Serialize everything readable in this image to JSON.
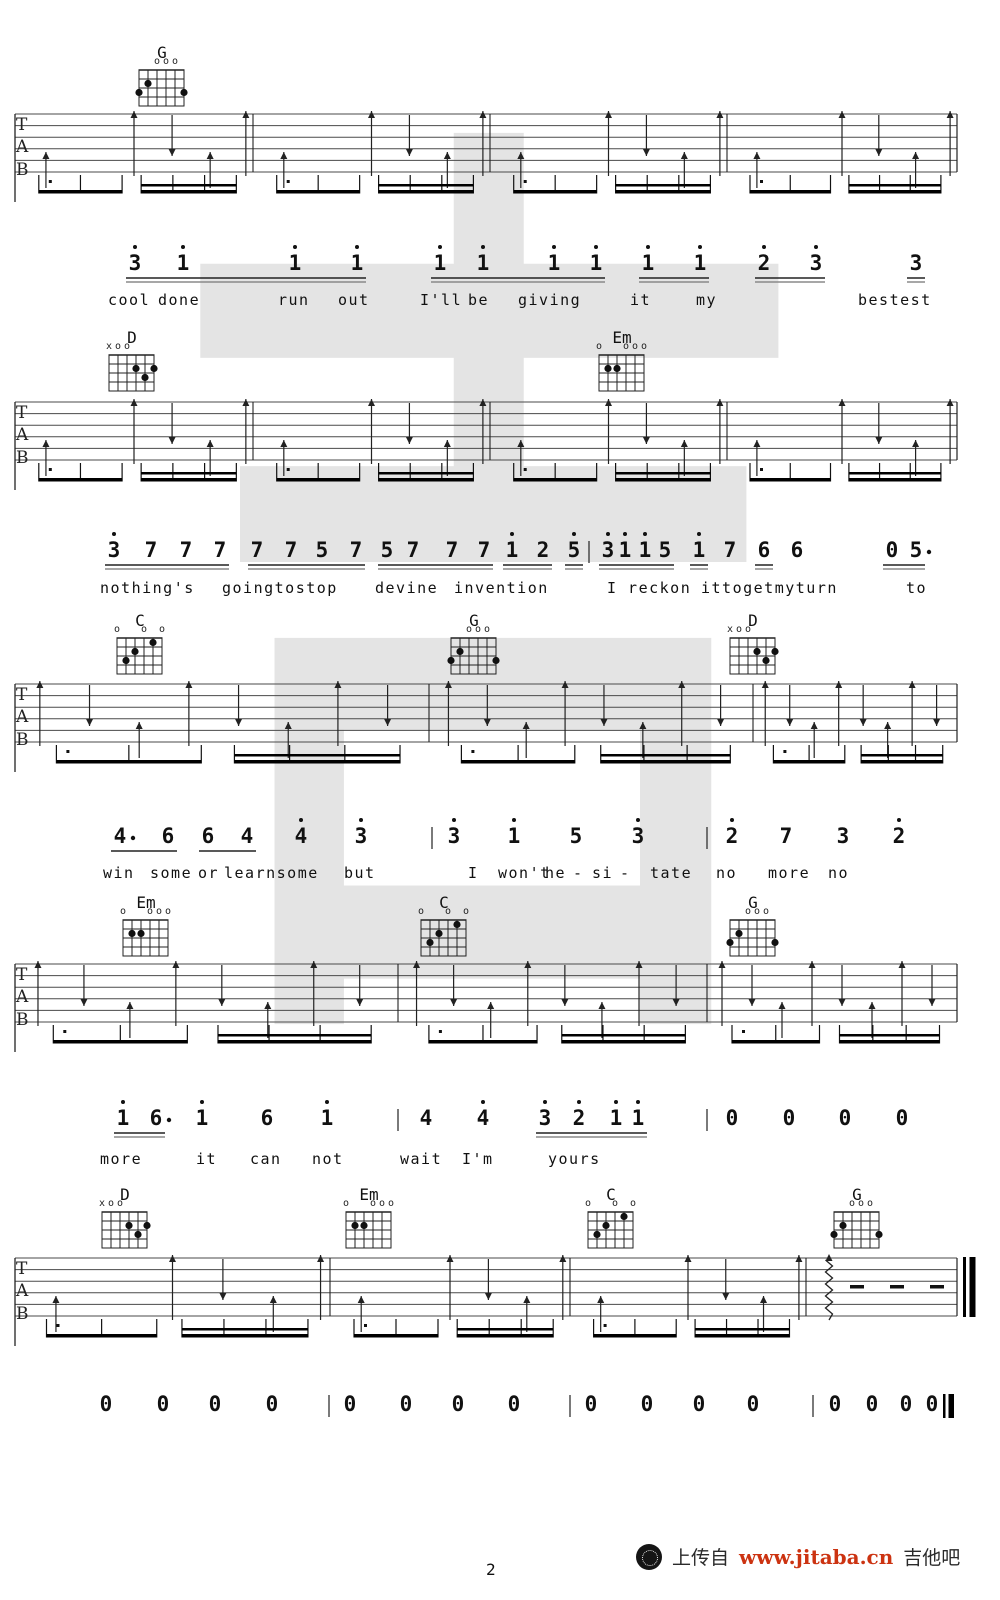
{
  "page": {
    "number": "2"
  },
  "watermark": {
    "glyph": "吉",
    "color": "#cfcfcf"
  },
  "tab_letters": [
    "T",
    "A",
    "B"
  ],
  "footer": {
    "upload_text": "上传自",
    "url": "www.jitaba.cn",
    "site_name": "吉他吧",
    "url_color": "#cc3311",
    "logo": "guitar-site-logo-icon"
  },
  "chord_shapes": {
    "G": {
      "markers": [
        [
          3,
          "o"
        ],
        [
          4,
          "o"
        ],
        [
          5,
          "o"
        ]
      ],
      "dots": [
        [
          2,
          2
        ],
        [
          1,
          3
        ],
        [
          6,
          3
        ]
      ]
    },
    "D": {
      "markers": [
        [
          1,
          "x"
        ],
        [
          2,
          "o"
        ],
        [
          3,
          "o"
        ]
      ],
      "dots": [
        [
          4,
          2
        ],
        [
          6,
          2
        ],
        [
          5,
          3
        ]
      ]
    },
    "Em": {
      "markers": [
        [
          1,
          "o"
        ],
        [
          4,
          "o"
        ],
        [
          5,
          "o"
        ],
        [
          6,
          "o"
        ]
      ],
      "dots": [
        [
          2,
          2
        ],
        [
          3,
          2
        ]
      ]
    },
    "C": {
      "markers": [
        [
          1,
          "o"
        ],
        [
          4,
          "o"
        ],
        [
          6,
          "o"
        ]
      ],
      "dots": [
        [
          5,
          1
        ],
        [
          3,
          2
        ],
        [
          2,
          3
        ]
      ]
    }
  },
  "systems": [
    {
      "chords": [
        {
          "name": "G",
          "x": 162
        }
      ],
      "grid_y": 70,
      "staff": {
        "top": 114,
        "bars": [
          253,
          490,
          727
        ],
        "dense": false
      },
      "melody": {
        "ny": 251,
        "ly": 291,
        "tokens": [
          [
            "3",
            135,
            1,
            "a",
            0
          ],
          [
            "1",
            183,
            1,
            "a",
            0
          ],
          [
            "1",
            295,
            1,
            "a",
            0
          ],
          [
            "1",
            357,
            1,
            "a",
            0
          ],
          [
            "1",
            440,
            1,
            "b",
            0
          ],
          [
            "1",
            483,
            1,
            "b",
            0
          ],
          [
            "1",
            554,
            1,
            "b",
            0
          ],
          [
            "1",
            596,
            1,
            "b",
            0
          ],
          [
            "1",
            648,
            1,
            "c",
            0
          ],
          [
            "1",
            700,
            1,
            "c",
            0
          ],
          [
            "2",
            764,
            1,
            "d",
            0
          ],
          [
            "3",
            816,
            1,
            "d",
            0
          ],
          [
            "3",
            916,
            0,
            "e",
            0
          ]
        ],
        "glines": {},
        "bars": [],
        "lyrics": [
          [
            "cool",
            108
          ],
          [
            "done",
            158
          ],
          [
            "run",
            278
          ],
          [
            "out",
            338
          ],
          [
            "I'll",
            420
          ],
          [
            "be",
            468
          ],
          [
            "giving",
            518
          ],
          [
            "it",
            630
          ],
          [
            "my",
            696
          ],
          [
            "bestest",
            858
          ]
        ]
      }
    },
    {
      "chords": [
        {
          "name": "D",
          "x": 132
        },
        {
          "name": "Em",
          "x": 622
        }
      ],
      "grid_y": 355,
      "staff": {
        "top": 402,
        "bars": [
          253,
          490,
          727
        ],
        "dense": false
      },
      "melody": {
        "ny": 538,
        "ly": 579,
        "tokens": [
          [
            "3",
            114,
            1,
            "a",
            0
          ],
          [
            "7",
            151,
            0,
            "a",
            0
          ],
          [
            "7",
            186,
            0,
            "a",
            0
          ],
          [
            "7",
            220,
            0,
            "a",
            0
          ],
          [
            "7",
            257,
            0,
            "b",
            0
          ],
          [
            "7",
            291,
            0,
            "b",
            0
          ],
          [
            "5",
            322,
            0,
            "b",
            0
          ],
          [
            "7",
            356,
            0,
            "b",
            0
          ],
          [
            "5",
            387,
            0,
            "c",
            0
          ],
          [
            "7",
            413,
            0,
            "c",
            0
          ],
          [
            "7",
            452,
            0,
            "c",
            0
          ],
          [
            "7",
            484,
            0,
            "c",
            0
          ],
          [
            "1",
            512,
            1,
            "d",
            0
          ],
          [
            "2",
            543,
            0,
            "d",
            0
          ],
          [
            "5",
            574,
            1,
            "e",
            0
          ],
          [
            "3",
            608,
            1,
            "f",
            0
          ],
          [
            "1",
            625,
            1,
            "f",
            0
          ],
          [
            "1",
            645,
            1,
            "f",
            0
          ],
          [
            "5",
            665,
            0,
            "f",
            0
          ],
          [
            "1",
            699,
            1,
            "g",
            0
          ],
          [
            "7",
            730,
            0,
            null,
            0
          ],
          [
            "6",
            764,
            0,
            "h",
            0
          ],
          [
            "6",
            797,
            0,
            null,
            0
          ],
          [
            "0",
            892,
            0,
            "i",
            0
          ],
          [
            "5",
            916,
            0,
            "i",
            1
          ]
        ],
        "glines": {},
        "bars": [
          589
        ],
        "lyrics": [
          [
            "nothing's",
            100
          ],
          [
            "goingtostop",
            222
          ],
          [
            "devine",
            375
          ],
          [
            "invention",
            454
          ],
          [
            "I reckon",
            607
          ],
          [
            "ittogetmyturn",
            701
          ],
          [
            "to",
            906
          ]
        ]
      }
    },
    {
      "chords": [
        {
          "name": "C",
          "x": 140
        },
        {
          "name": "G",
          "x": 474
        },
        {
          "name": "D",
          "x": 753
        }
      ],
      "grid_y": 638,
      "staff": {
        "top": 684,
        "bars": [
          429,
          753
        ],
        "dense": true
      },
      "melody": {
        "ny": 824,
        "ly": 864,
        "tokens": [
          [
            "4",
            120,
            0,
            "a",
            1
          ],
          [
            "6",
            168,
            0,
            "a",
            0
          ],
          [
            "6",
            208,
            0,
            "b",
            0
          ],
          [
            "4",
            247,
            0,
            "b",
            0
          ],
          [
            "4",
            301,
            1,
            null,
            0
          ],
          [
            "3",
            361,
            1,
            null,
            0
          ],
          [
            "3",
            454,
            1,
            null,
            0
          ],
          [
            "1",
            514,
            1,
            null,
            0
          ],
          [
            "5",
            576,
            0,
            null,
            0
          ],
          [
            "3",
            638,
            1,
            null,
            0
          ],
          [
            "2",
            732,
            1,
            null,
            0
          ],
          [
            "7",
            786,
            0,
            null,
            0
          ],
          [
            "3",
            843,
            0,
            null,
            0
          ],
          [
            "2",
            899,
            1,
            null,
            0
          ]
        ],
        "glines": {
          "a": 1,
          "b": 1
        },
        "bars": [
          432,
          707
        ],
        "lyrics": [
          [
            "win",
            103
          ],
          [
            "some",
            150
          ],
          [
            "or",
            198
          ],
          [
            "learnsome",
            224
          ],
          [
            "but",
            344
          ],
          [
            "I",
            468
          ],
          [
            "won't",
            498
          ],
          [
            "he",
            545
          ],
          [
            "-",
            573
          ],
          [
            "si",
            592
          ],
          [
            "-",
            620
          ],
          [
            "tate",
            650
          ],
          [
            "no",
            716
          ],
          [
            "more",
            768
          ],
          [
            "no",
            828
          ]
        ]
      }
    },
    {
      "chords": [
        {
          "name": "Em",
          "x": 146
        },
        {
          "name": "C",
          "x": 444
        },
        {
          "name": "G",
          "x": 753
        }
      ],
      "grid_y": 920,
      "staff": {
        "top": 964,
        "bars": [
          398,
          707
        ],
        "dense": true
      },
      "melody": {
        "ny": 1106,
        "ly": 1150,
        "tokens": [
          [
            "1",
            123,
            1,
            "a",
            0
          ],
          [
            "6",
            156,
            0,
            "a",
            1
          ],
          [
            "1",
            202,
            1,
            null,
            0
          ],
          [
            "6",
            267,
            0,
            null,
            0
          ],
          [
            "1",
            327,
            1,
            null,
            0
          ],
          [
            "4",
            426,
            0,
            null,
            0
          ],
          [
            "4",
            483,
            1,
            null,
            0
          ],
          [
            "3",
            545,
            1,
            "b",
            0
          ],
          [
            "2",
            579,
            1,
            "b",
            0
          ],
          [
            "1",
            616,
            1,
            "b",
            0
          ],
          [
            "1",
            638,
            1,
            "b",
            0
          ],
          [
            "0",
            732,
            0,
            null,
            0
          ],
          [
            "0",
            789,
            0,
            null,
            0
          ],
          [
            "0",
            845,
            0,
            null,
            0
          ],
          [
            "0",
            902,
            0,
            null,
            0
          ]
        ],
        "glines": {},
        "bars": [
          398,
          707
        ],
        "lyrics": [
          [
            "more",
            100
          ],
          [
            "it",
            196
          ],
          [
            "can",
            250
          ],
          [
            "not",
            312
          ],
          [
            "wait",
            400
          ],
          [
            "I'm",
            462
          ],
          [
            "yours",
            548
          ]
        ]
      }
    },
    {
      "chords": [
        {
          "name": "D",
          "x": 125
        },
        {
          "name": "Em",
          "x": 369
        },
        {
          "name": "C",
          "x": 611
        },
        {
          "name": "G",
          "x": 857
        }
      ],
      "grid_y": 1212,
      "staff": {
        "top": 1258,
        "bars": [
          330,
          570,
          806
        ],
        "dense": false,
        "stop_x": 806,
        "specials": {
          "zigzag": 829,
          "dashes": [
            850,
            890,
            930
          ],
          "final_double": 963
        }
      },
      "melody": {
        "ny": 1392,
        "ly": null,
        "tokens": [
          [
            "0",
            106,
            0,
            null,
            0
          ],
          [
            "0",
            163,
            0,
            null,
            0
          ],
          [
            "0",
            215,
            0,
            null,
            0
          ],
          [
            "0",
            272,
            0,
            null,
            0
          ],
          [
            "0",
            350,
            0,
            null,
            0
          ],
          [
            "0",
            406,
            0,
            null,
            0
          ],
          [
            "0",
            458,
            0,
            null,
            0
          ],
          [
            "0",
            514,
            0,
            null,
            0
          ],
          [
            "0",
            591,
            0,
            null,
            0
          ],
          [
            "0",
            647,
            0,
            null,
            0
          ],
          [
            "0",
            699,
            0,
            null,
            0
          ],
          [
            "0",
            753,
            0,
            null,
            0
          ],
          [
            "0",
            835,
            0,
            null,
            0
          ],
          [
            "0",
            872,
            0,
            null,
            0
          ],
          [
            "0",
            906,
            0,
            null,
            0
          ],
          [
            "0",
            932,
            0,
            null,
            0
          ]
        ],
        "glines": {},
        "bars": [
          329,
          570,
          813
        ],
        "final": 943,
        "lyrics": []
      }
    }
  ]
}
